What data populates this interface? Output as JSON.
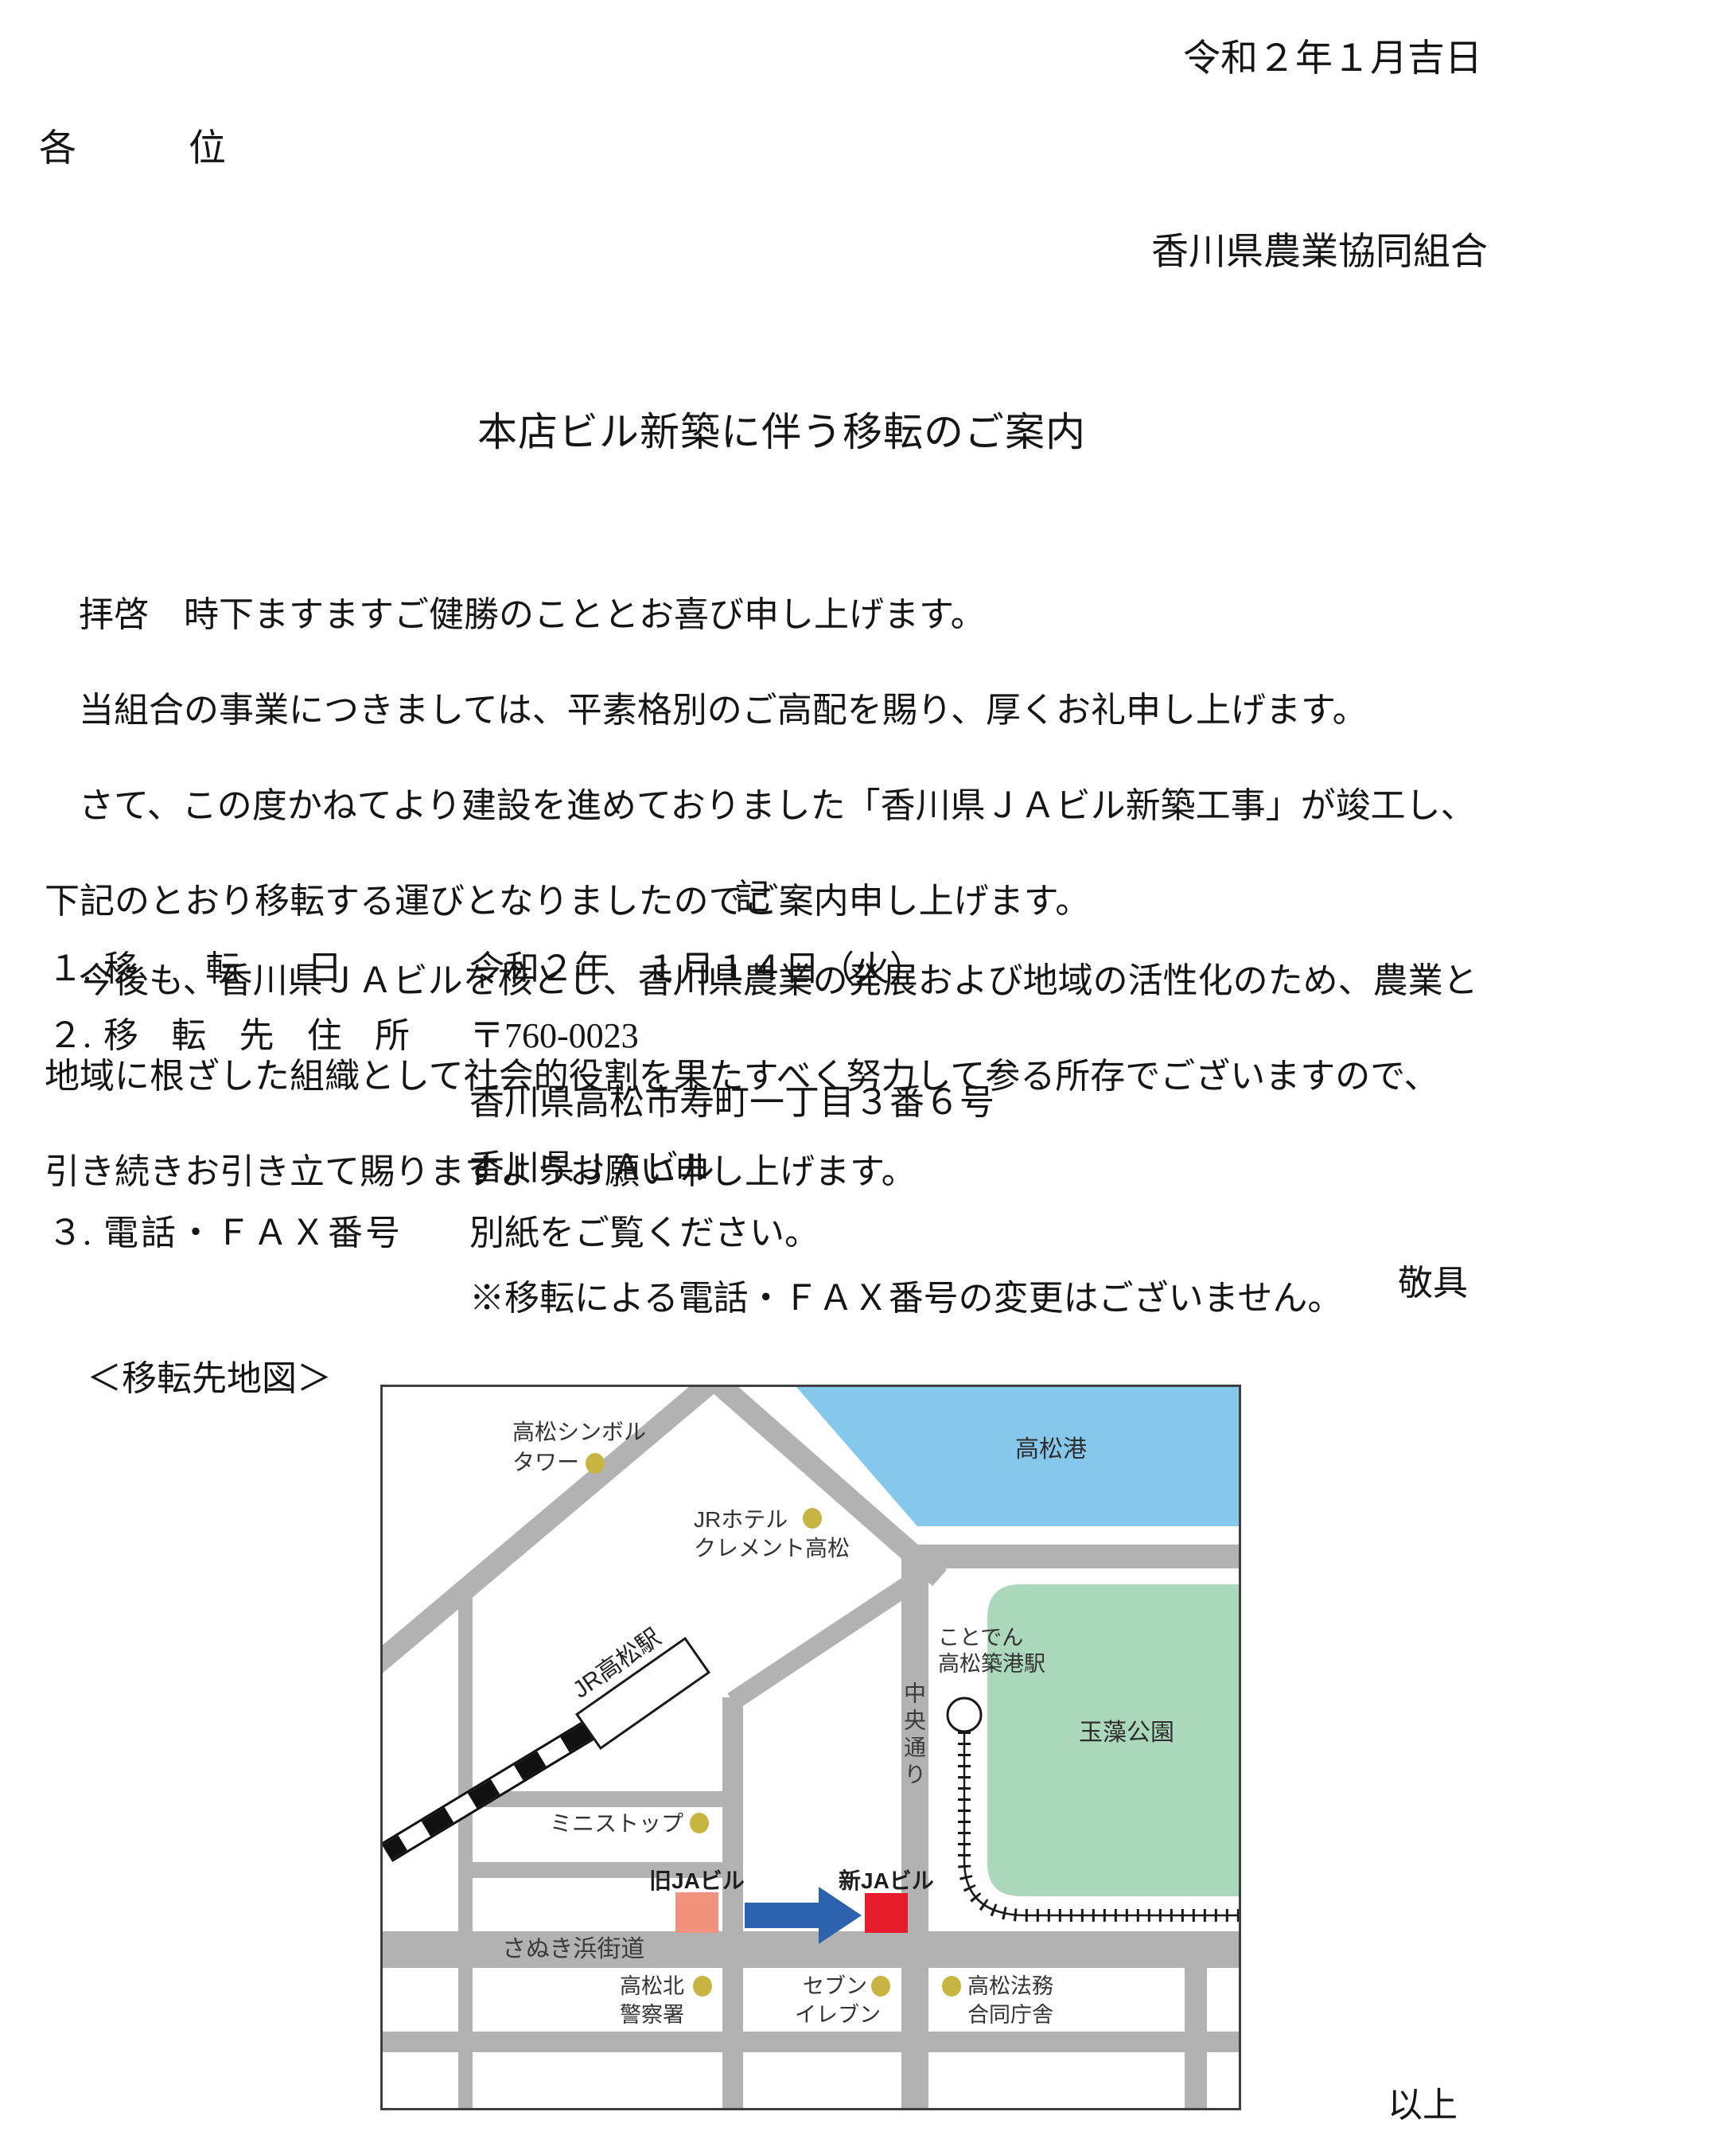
{
  "letter": {
    "date": "令和２年１月吉日",
    "addressee": "各　　　位",
    "sender": "香川県農業協同組合",
    "title": "本店ビル新築に伴う移転のご案内",
    "p1": "拝啓　時下ますますご健勝のこととお喜び申し上げます。",
    "p2": "当組合の事業につきましては、平素格別のご高配を賜り、厚くお礼申し上げます。",
    "p3a": "さて、この度かねてより建設を進めておりました「香川県ＪＡビル新築工事」が竣工し、",
    "p3b": "下記のとおり移転する運びとなりましたのでご案内申し上げます。",
    "p4a": "今後も、香川県ＪＡビルを核とし、香川県農業の発展および地域の活性化のため、農業と",
    "p4b": "地域に根ざした組織として社会的役割を果たすべく努力して参る所存でございますので、",
    "p4c": "引き続きお引き立て賜りますようお願い申し上げます。",
    "closing": "敬具",
    "record_heading": "記",
    "items": [
      {
        "no": "１.",
        "label": "移転日",
        "value": "令和２年　１月１４日（火）"
      },
      {
        "no": "２.",
        "label": "移転先住所",
        "value": "〒760-0023",
        "value2": "香川県高松市寿町一丁目３番６号",
        "value3": "香川県ＪＡビル"
      },
      {
        "no": "３.",
        "label": "電話・ＦＡＸ番号",
        "value": "別紙をご覧ください。",
        "note": "※移転による電話・ＦＡＸ番号の変更はございません。"
      }
    ],
    "map_caption": "＜移転先地図＞",
    "end_mark": "以上"
  },
  "map": {
    "labels": {
      "port": "高松港",
      "symbol_tower_l1": "高松シンボル",
      "symbol_tower_l2": "タワー",
      "hotel_l1": "JRホテル",
      "hotel_l2": "クレメント高松",
      "jr_station": "JR高松駅",
      "kotoden_l1": "ことでん",
      "kotoden_l2": "高松築港駅",
      "park": "玉藻公園",
      "chuo_dori": "中央通り",
      "ministop": "ミニストップ",
      "old_ja": "旧JAビル",
      "new_ja": "新JAビル",
      "sanuki": "さぬき浜街道",
      "police_l1": "高松北",
      "police_l2": "警察署",
      "seven_l1": "セブン",
      "seven_l2": "イレブン",
      "houmu_l1": "高松法務",
      "houmu_l2": "合同庁舎"
    },
    "colors": {
      "road": "#b2b2b2",
      "water": "#85c8eb",
      "park": "#abd8bb",
      "old_ja": "#f2917c",
      "new_ja": "#e81b2b",
      "arrow": "#2d63ae",
      "poi_dot": "#c8b440",
      "rail": "#1a1a1a"
    }
  }
}
